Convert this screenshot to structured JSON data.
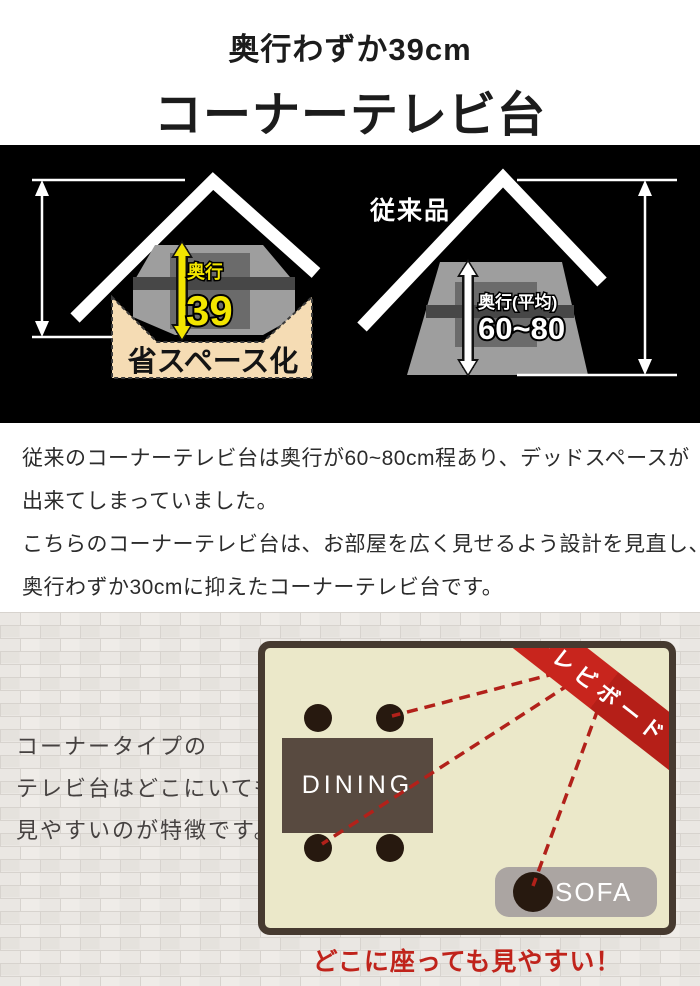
{
  "header": {
    "subtitle": "奥行わずか39cm",
    "title": "コーナーテレビ台"
  },
  "comparison": {
    "new_product": {
      "depth_label": "奥行",
      "depth_value": "39",
      "space_label": "省スペース化"
    },
    "conventional": {
      "name_label": "従来品",
      "depth_label": "奥行(平均)",
      "depth_value": "60~80"
    }
  },
  "description": {
    "lines": [
      "従来のコーナーテレビ台は奥行が60~80cm程あり、デッドスペースが",
      "出来てしまっていました。",
      "こちらのコーナーテレビ台は、お部屋を広く見せるよう設計を見直し、",
      "奥行わずか30cmに抑えたコーナーテレビ台です。"
    ]
  },
  "floorplan": {
    "side_text_lines": [
      "コーナータイプの",
      "テレビ台はどこにいても",
      "見やすいのが特徴です。"
    ],
    "ribbon_label": "テレビボード",
    "dining_label": "DINING",
    "sofa_label": "SOFA",
    "caption": "どこに座っても見やすい！"
  },
  "colors": {
    "accent_red": "#c0231b",
    "highlight_yellow": "#f2e500",
    "space_beige": "#f5dcb4",
    "room_cream": "#ebe8c9",
    "room_border_brown": "#463a30",
    "wood_brown": "#584a40",
    "sofa_gray": "#aba5a2",
    "stand_gray": "#9e9e9e",
    "section_black": "#000000"
  }
}
